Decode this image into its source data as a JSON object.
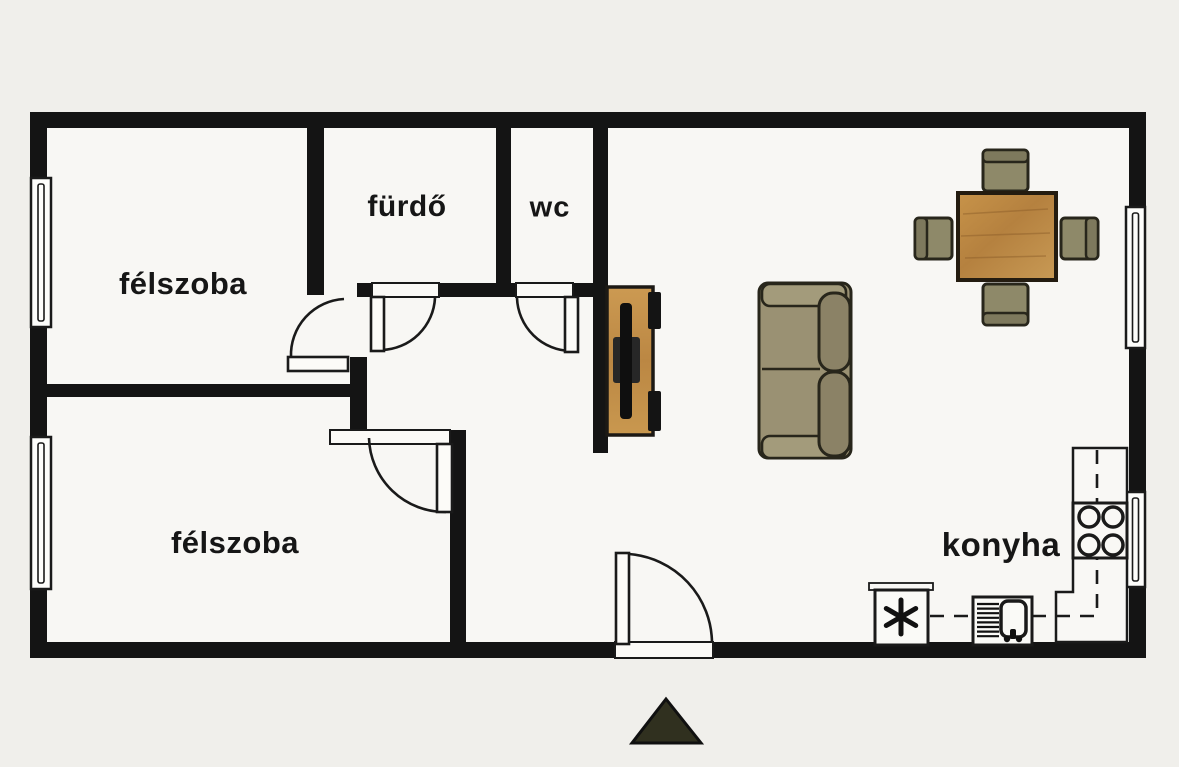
{
  "rooms": [
    {
      "id": "felszoba-1",
      "label": "félszoba",
      "cx": 183,
      "cy": 284,
      "size": "lbl-lg"
    },
    {
      "id": "furdo",
      "label": "fürdő",
      "cx": 407,
      "cy": 207,
      "size": "lbl-md"
    },
    {
      "id": "wc",
      "label": "wc",
      "cx": 550,
      "cy": 208,
      "size": "lbl-wc"
    },
    {
      "id": "felszoba-2",
      "label": "félszoba",
      "cx": 235,
      "cy": 543,
      "size": "lbl-lg"
    },
    {
      "id": "konyha",
      "label": "konyha",
      "cx": 1001,
      "cy": 545,
      "size": "lbl-konyha"
    }
  ],
  "colors": {
    "bg": "#f0efeb",
    "floor": "#f8f7f4",
    "wall": "#141414",
    "outline": "#1a1a1a",
    "furniture_outline": "#28261b",
    "wood_light": "#cc9a52",
    "wood_mid": "#b5813f",
    "wood_dark": "#8a5c28",
    "chair_fill": "#8e8969",
    "chair_back": "#7e795d",
    "sofa_fill": "#9a9173",
    "sofa_arm": "#a39b7b",
    "sofa_back": "#8b8266",
    "tv_black": "#0f0f0f",
    "tv_box": "#272727",
    "north_fill": "#30301f"
  },
  "plan": {
    "floor": {
      "x": 38,
      "y": 120,
      "w": 1100,
      "h": 530
    },
    "walls": [
      {
        "name": "wall-top",
        "x": 30,
        "y": 112,
        "w": 1116,
        "h": 16
      },
      {
        "name": "wall-left",
        "x": 30,
        "y": 112,
        "w": 17,
        "h": 546
      },
      {
        "name": "wall-right",
        "x": 1129,
        "y": 112,
        "w": 17,
        "h": 546
      },
      {
        "name": "wall-bottom-left",
        "x": 30,
        "y": 642,
        "w": 585,
        "h": 16
      },
      {
        "name": "wall-bottom-right",
        "x": 713,
        "y": 642,
        "w": 433,
        "h": 16
      },
      {
        "name": "wall-felszoba1-right",
        "x": 307,
        "y": 126,
        "w": 17,
        "h": 169
      },
      {
        "name": "wall-bath-bottom-a",
        "x": 357,
        "y": 283,
        "w": 18,
        "h": 14
      },
      {
        "name": "wall-bath-bottom-b",
        "x": 439,
        "y": 283,
        "w": 78,
        "h": 14
      },
      {
        "name": "wall-bath-bottom-c",
        "x": 572,
        "y": 283,
        "w": 36,
        "h": 14
      },
      {
        "name": "wall-furdo-wc-separator",
        "x": 496,
        "y": 126,
        "w": 15,
        "h": 157
      },
      {
        "name": "wall-hall-living",
        "x": 593,
        "y": 126,
        "w": 15,
        "h": 327
      },
      {
        "name": "wall-hall-jog",
        "x": 350,
        "y": 357,
        "w": 17,
        "h": 76
      },
      {
        "name": "wall-felszoba2-top",
        "x": 38,
        "y": 384,
        "w": 329,
        "h": 13
      },
      {
        "name": "wall-felszoba2-right",
        "x": 450,
        "y": 430,
        "w": 16,
        "h": 212
      }
    ],
    "windows": [
      {
        "name": "window-felszoba1",
        "x": 31,
        "y": 178,
        "w": 20,
        "h": 149
      },
      {
        "name": "window-felszoba2",
        "x": 31,
        "y": 437,
        "w": 20,
        "h": 152
      },
      {
        "name": "window-living",
        "x": 1126,
        "y": 207,
        "w": 19,
        "h": 141
      },
      {
        "name": "window-kitchen",
        "x": 1126,
        "y": 492,
        "w": 19,
        "h": 95
      }
    ],
    "door_thresholds": [
      {
        "name": "threshold-furdo",
        "x": 372,
        "y": 283,
        "w": 67,
        "h": 14
      },
      {
        "name": "threshold-wc",
        "x": 516,
        "y": 283,
        "w": 57,
        "h": 14
      },
      {
        "name": "threshold-felszoba2",
        "x": 330,
        "y": 430,
        "w": 120,
        "h": 14
      },
      {
        "name": "threshold-entrance",
        "x": 615,
        "y": 642,
        "w": 98,
        "h": 16
      }
    ],
    "doors": [
      {
        "name": "door-felszoba1",
        "leaf": {
          "x": 288,
          "y": 357,
          "w": 60,
          "h": 14
        },
        "arc": "M 291,357 A 56,56 0 0 1 344,299"
      },
      {
        "name": "door-furdo",
        "leaf": {
          "x": 371,
          "y": 297,
          "w": 13,
          "h": 54
        },
        "arc": "M 382,350 A 55,55 0 0 0 435,298"
      },
      {
        "name": "door-wc",
        "leaf": {
          "x": 565,
          "y": 297,
          "w": 13,
          "h": 55
        },
        "arc": "M 517,298 A 55,55 0 0 0 571,351"
      },
      {
        "name": "door-felszoba2",
        "leaf": {
          "x": 437,
          "y": 444,
          "w": 15,
          "h": 68
        },
        "arc": "M 369,438 A 76,76 0 0 0 446,512"
      },
      {
        "name": "door-entrance",
        "leaf": {
          "x": 616,
          "y": 553,
          "w": 13,
          "h": 91
        },
        "arc": "M 629,554 A 90,90 0 0 1 712,643"
      }
    ],
    "kitchen": {
      "counter_points": "1073,448 1127,448 1127,642 1056,642 1056,592 1073,592",
      "stove": {
        "x": 1073,
        "y": 503,
        "w": 54,
        "h": 55
      },
      "burners": [
        {
          "cx": 1089,
          "cy": 517,
          "r": 10
        },
        {
          "cx": 1113,
          "cy": 517,
          "r": 10
        },
        {
          "cx": 1089,
          "cy": 545,
          "r": 10
        },
        {
          "cx": 1113,
          "cy": 545,
          "r": 10
        }
      ],
      "fridge": {
        "x": 875,
        "y": 590,
        "w": 53,
        "h": 55
      },
      "fridge_lip": {
        "x": 869,
        "y": 583,
        "w": 64,
        "h": 7
      },
      "snowflake": {
        "cx": 901,
        "cy": 617,
        "r": 17
      },
      "sink_unit": {
        "x": 973,
        "y": 597,
        "w": 59,
        "h": 48
      },
      "basin": {
        "x": 1001,
        "y": 601,
        "w": 25,
        "h": 36
      },
      "drain_lines": {
        "x1": 977,
        "x2": 999,
        "y_start": 604,
        "step": 4.6,
        "count": 8
      },
      "faucet": {
        "x": 1010,
        "y": 629,
        "w": 6,
        "h": 10,
        "c1x": 1007,
        "c2x": 1019,
        "cy": 639
      },
      "dash_vertical": {
        "x": 1097,
        "y1": 450,
        "y2": 614
      },
      "dash_horizontal": [
        {
          "x1": 930,
          "x2": 973,
          "y": 616
        },
        {
          "x1": 1032,
          "x2": 1097,
          "y": 616
        }
      ]
    },
    "dining": {
      "table": {
        "x": 958,
        "y": 193,
        "w": 98,
        "h": 87
      },
      "chairs": [
        {
          "name": "chair-top",
          "x": 983,
          "y": 150,
          "w": 45,
          "h": 41,
          "back": "top"
        },
        {
          "name": "chair-bottom",
          "x": 983,
          "y": 284,
          "w": 45,
          "h": 41,
          "back": "bottom"
        },
        {
          "name": "chair-left",
          "x": 915,
          "y": 218,
          "w": 37,
          "h": 41,
          "back": "left"
        },
        {
          "name": "chair-right",
          "x": 1061,
          "y": 218,
          "w": 37,
          "h": 41,
          "back": "right"
        }
      ]
    },
    "sofa": {
      "body": {
        "x": 759,
        "y": 283,
        "w": 92,
        "h": 175
      },
      "arm_top": {
        "x": 762,
        "y": 284,
        "w": 84,
        "h": 22
      },
      "arm_bottom": {
        "x": 762,
        "y": 436,
        "w": 84,
        "h": 22
      },
      "seat_seam": {
        "x1": 762,
        "y1": 369,
        "x2": 820,
        "y2": 369
      },
      "back_cushions": [
        {
          "x": 819,
          "y": 293,
          "w": 31,
          "h": 78
        },
        {
          "x": 819,
          "y": 372,
          "w": 31,
          "h": 84
        }
      ]
    },
    "tv_stand": {
      "stand": {
        "x": 607,
        "y": 287,
        "w": 46,
        "h": 148
      },
      "speakers": [
        {
          "x": 648,
          "y": 292,
          "w": 13,
          "h": 37
        },
        {
          "x": 648,
          "y": 391,
          "w": 13,
          "h": 40
        }
      ],
      "tv_box": {
        "x": 613,
        "y": 337,
        "w": 27,
        "h": 46
      },
      "tv_bar": {
        "x": 620,
        "y": 303,
        "w": 12,
        "h": 116
      }
    },
    "north_arrow": {
      "points": "666,699 701,743 632,743"
    }
  }
}
